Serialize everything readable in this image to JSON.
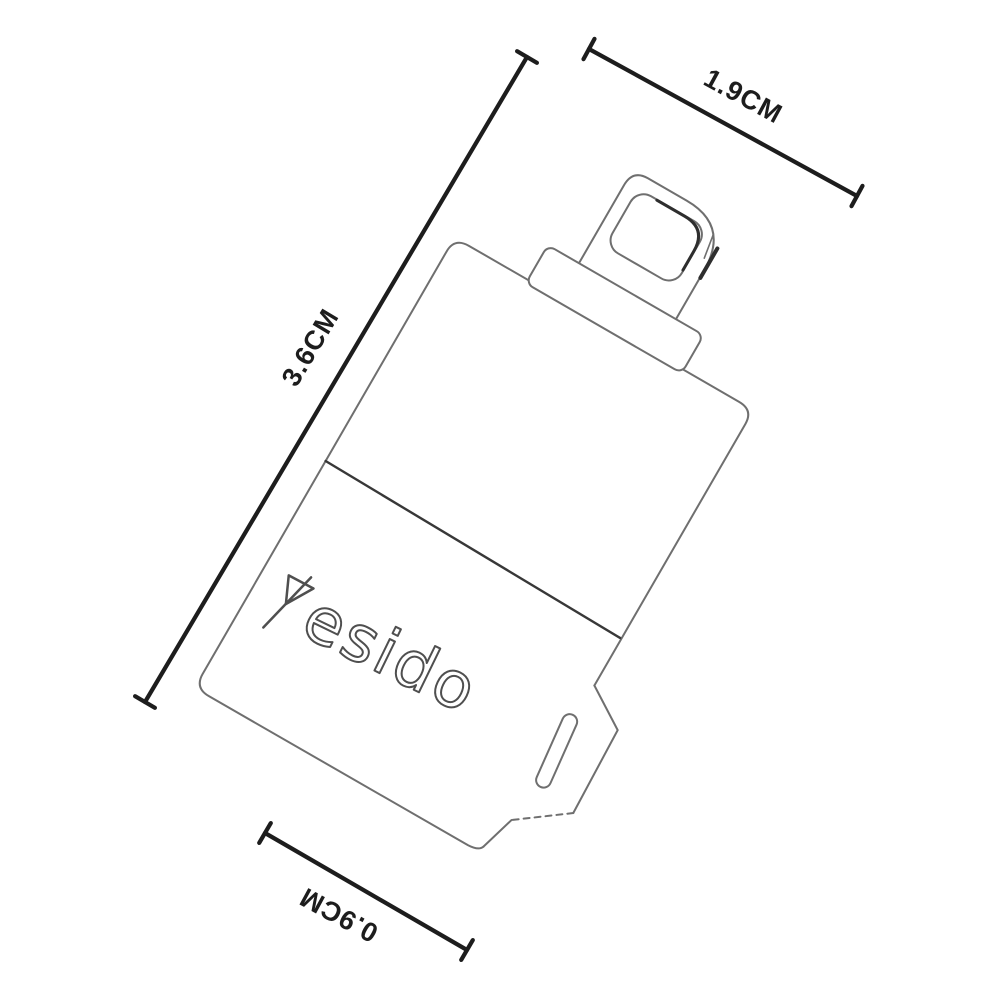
{
  "brand": {
    "logo_full": "yesido",
    "logo_text_part": "esido"
  },
  "dims": {
    "width": {
      "label": "1.9CM"
    },
    "height": {
      "label": "3.6CM"
    },
    "depth": {
      "label": "0.9CM"
    }
  },
  "colors": {
    "background": "#ffffff",
    "outline": "#6f6f6f",
    "outline_dark": "#2e2e2e",
    "seam": "#383838",
    "dimension_line": "#1d1d1d",
    "label_text": "#1d1d1d",
    "logo_stroke": "#4f4f4f"
  }
}
